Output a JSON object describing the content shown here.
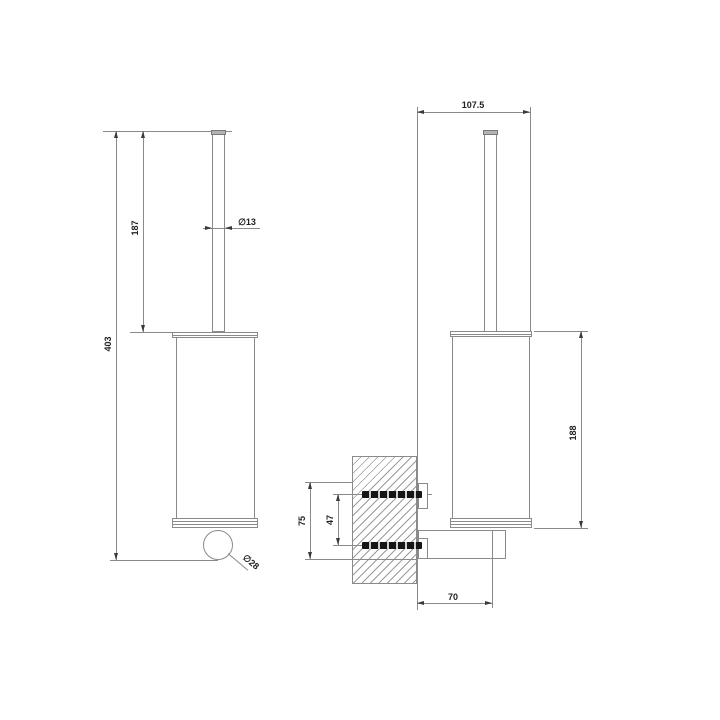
{
  "drawing_type": "technical-dimension-drawing",
  "product": "wall-mounted toilet brush holder, two orthographic views",
  "colors": {
    "background": "#ffffff",
    "line": "#8a8a8a",
    "text": "#222222",
    "screw": "#1a1a1a",
    "hatch": "#9a9a9a",
    "cap_fill": "#b3b3b3"
  },
  "front_view": {
    "dim_overall_height": "403",
    "dim_handle_height": "187",
    "dim_handle_diameter": "∅13",
    "dim_knob_diameter": "∅28"
  },
  "side_view": {
    "dim_width": "107.5",
    "dim_body_height": "188",
    "dim_mount_span": "75",
    "dim_screw_spacing": "47",
    "dim_wall_to_axis": "70"
  }
}
